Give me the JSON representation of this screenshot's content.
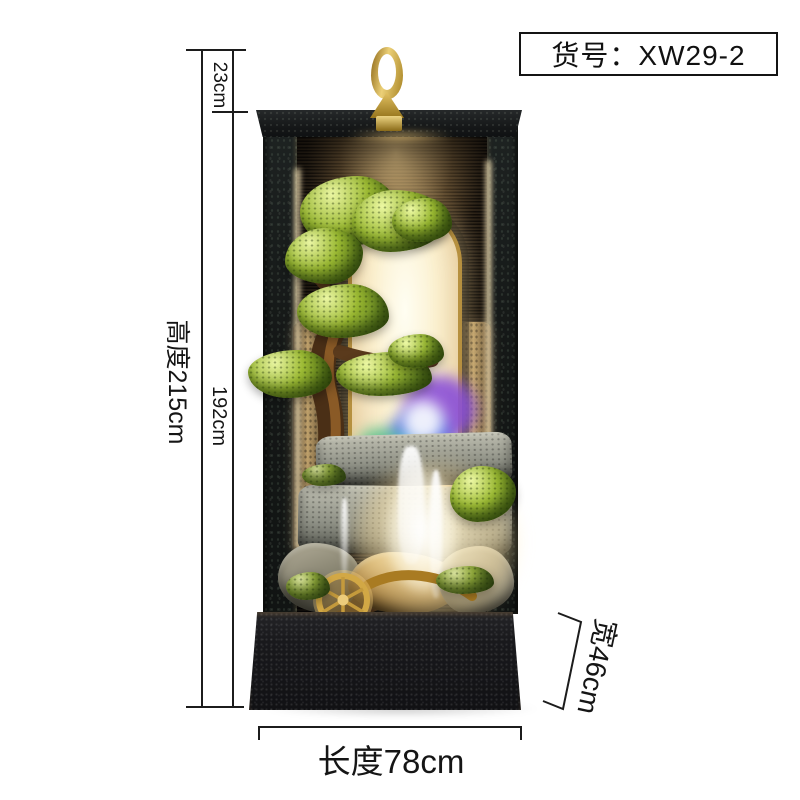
{
  "code_box": {
    "text": "货号：XW29-2"
  },
  "dims": {
    "hook_offset": "23cm",
    "total_height": "高度215cm",
    "inner_height": "192cm",
    "length": "长度78cm",
    "depth": "宽46cm"
  },
  "colors": {
    "background": "#ffffff",
    "annotation_line": "#1c1c1c",
    "hook_gold": "#d9b857",
    "frame_dark": "#17191a",
    "wall_warm": "#c9a05c",
    "arch_glow": "#fdf3d6",
    "foliage_green": "#9cbb33",
    "led_purple": "#8a4fd8",
    "led_blue": "#3f66e0",
    "led_cyan": "#4fd4d8",
    "stone_gray": "#9a9c90",
    "base_black": "#161618"
  }
}
